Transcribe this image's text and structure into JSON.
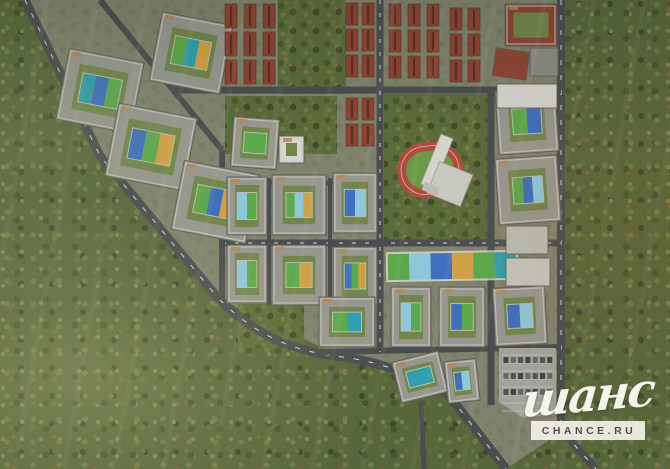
{
  "watermark": {
    "script": "шанс",
    "domain": "CHANCE.RU"
  },
  "palette": {
    "forest": "#57663b",
    "ground": "#81836f",
    "road": "#4a4d4f",
    "road_dash": "#d8d8cf",
    "building_wall": "#97978f",
    "building_edge": "#5f5f5a",
    "roof_trim": "#c9c9c1",
    "roof_accent": "#b2895a",
    "courtyard": "#72854c",
    "brick": "#8d4434",
    "brick_dark": "#5f2d22",
    "white_building": "#d6d5ce",
    "track_red": "#b24b3d",
    "field_green": "#699b47",
    "park_green": "#5c6b3a",
    "parking_gray": "#a2a39c",
    "playground_teal": "#2e9fae",
    "playground_blue": "#3f6fbe",
    "playground_green": "#5ca94c",
    "playground_lightblue": "#8ec7dc",
    "playground_orange": "#d2a044"
  },
  "map": {
    "width": 670,
    "height": 469,
    "features": [
      {
        "t": "ground",
        "n": "development-site-ground",
        "pts": [
          [
            25,
            0
          ],
          [
            561,
            0
          ],
          [
            561,
            432
          ],
          [
            506,
            469
          ],
          [
            446,
            392
          ],
          [
            340,
            356
          ],
          [
            218,
            298
          ],
          [
            100,
            156
          ]
        ]
      },
      {
        "t": "park",
        "n": "park-townhouse-gap",
        "x": 278,
        "y": 0,
        "w": 68,
        "h": 94
      },
      {
        "t": "park",
        "n": "park-central",
        "x": 225,
        "y": 96,
        "w": 112,
        "h": 58
      },
      {
        "t": "park",
        "n": "school-park",
        "x": 384,
        "y": 94,
        "w": 106,
        "h": 152
      },
      {
        "t": "park",
        "n": "park-south",
        "x": 238,
        "y": 304,
        "w": 66,
        "h": 44
      },
      {
        "t": "road",
        "n": "boundary-road-west",
        "d": "M25,0 L100,156 L218,298 C262,342 302,352 342,357 C384,362 416,377 448,394 L506,469",
        "w": 9
      },
      {
        "t": "road",
        "n": "boundary-road-west-markings",
        "d": "M25,0 L100,156 L218,298 C262,342 302,352 342,357 C384,362 416,377 448,394 L506,469",
        "w": 1,
        "c": "dash",
        "dash": "5 10"
      },
      {
        "t": "road",
        "n": "boundary-road-east",
        "d": "M561,0 L561,430 L596,469",
        "w": 8
      },
      {
        "t": "road",
        "n": "boundary-road-east-markings",
        "d": "M561,0 L561,430 L596,469",
        "w": 1,
        "c": "dash",
        "dash": "5 10"
      },
      {
        "t": "road",
        "n": "street-north",
        "d": "M173,90 L561,90",
        "w": 7
      },
      {
        "t": "road",
        "n": "street-central",
        "d": "M222,243 L561,243",
        "w": 7
      },
      {
        "t": "road",
        "n": "street-central-markings",
        "d": "M222,243 L561,243",
        "w": 1,
        "c": "dash",
        "dash": "4 9"
      },
      {
        "t": "road",
        "n": "street-south",
        "d": "M322,352 L561,347",
        "w": 6
      },
      {
        "t": "road",
        "n": "street-south-exit",
        "d": "M421,402 L424,469",
        "w": 5
      },
      {
        "t": "road",
        "n": "street-inner-diagonal",
        "d": "M100,0 L222,150",
        "w": 6
      },
      {
        "t": "road",
        "n": "street-west-vertical",
        "d": "M222,150 L222,300",
        "w": 6
      },
      {
        "t": "road",
        "n": "street-grid-north",
        "d": "M222,183 L380,183",
        "w": 5
      },
      {
        "t": "road",
        "n": "street-grid-vertical-1",
        "d": "M269,178 L269,305",
        "w": 4
      },
      {
        "t": "road",
        "n": "street-grid-vertical-2",
        "d": "M330,178 L330,305",
        "w": 4
      },
      {
        "t": "road",
        "n": "street-mid-vertical",
        "d": "M380,0 L380,352",
        "w": 7
      },
      {
        "t": "road",
        "n": "street-mid-vertical-markings",
        "d": "M380,0 L380,352",
        "w": 1,
        "c": "dash",
        "dash": "4 9"
      },
      {
        "t": "road",
        "n": "street-east-vertical",
        "d": "M491,90 L491,405",
        "w": 7
      },
      {
        "t": "stadium",
        "n": "stadium-running-track",
        "x": 397,
        "y": 142,
        "w": 66,
        "h": 56,
        "rot": -6
      },
      {
        "t": "school",
        "n": "school-building",
        "x": 441,
        "y": 134,
        "rot": 22
      },
      {
        "t": "strip",
        "n": "playground-strip",
        "x": 388,
        "y": 253,
        "w": 128,
        "h": 26,
        "rot": -1,
        "colors": [
          "#5ca94c",
          "#8ec7dc",
          "#3f6fbe",
          "#d2a044",
          "#5ca94c",
          "#2e9fae"
        ]
      },
      {
        "t": "parking",
        "n": "parking-lot",
        "pts": [
          [
            499,
            348
          ],
          [
            556,
            348
          ],
          [
            556,
            414
          ],
          [
            524,
            418
          ],
          [
            499,
            402
          ]
        ]
      },
      {
        "t": "block",
        "n": "courtyard-block-a1",
        "x": 62,
        "y": 55,
        "w": 76,
        "h": 72,
        "rot": 11,
        "pg": [
          "#2e9fae",
          "#3f6fbe",
          "#5ca94c"
        ]
      },
      {
        "t": "block",
        "n": "courtyard-block-a2",
        "x": 155,
        "y": 18,
        "w": 72,
        "h": 70,
        "rot": 11,
        "pg": [
          "#5ca94c",
          "#2e9fae",
          "#d2a044"
        ]
      },
      {
        "t": "block",
        "n": "courtyard-block-a3",
        "x": 111,
        "y": 110,
        "w": 80,
        "h": 74,
        "rot": 11,
        "pg": [
          "#3f6fbe",
          "#5ca94c",
          "#d2a044"
        ]
      },
      {
        "t": "block",
        "n": "courtyard-block-a4",
        "x": 177,
        "y": 167,
        "w": 76,
        "h": 70,
        "rot": 11,
        "pg": [
          "#5ca94c",
          "#3f6fbe",
          "#d2a044"
        ]
      },
      {
        "t": "block",
        "n": "courtyard-block-a5",
        "x": 232,
        "y": 118,
        "w": 46,
        "h": 50,
        "rot": 4,
        "pg": [
          "#5ca94c"
        ]
      },
      {
        "t": "block",
        "n": "courtyard-block-b1",
        "x": 227,
        "y": 177,
        "w": 40,
        "h": 58,
        "pg": [
          "#8ec7dc",
          "#5ca94c"
        ]
      },
      {
        "t": "block",
        "n": "courtyard-block-b2",
        "x": 272,
        "y": 175,
        "w": 54,
        "h": 60,
        "pg": [
          "#5ca94c",
          "#8ec7dc",
          "#d2a044"
        ]
      },
      {
        "t": "block",
        "n": "courtyard-block-b3",
        "x": 333,
        "y": 173,
        "w": 44,
        "h": 60,
        "pg": [
          "#3f6fbe",
          "#8ec7dc"
        ]
      },
      {
        "t": "block",
        "n": "courtyard-block-b4",
        "x": 227,
        "y": 245,
        "w": 40,
        "h": 58,
        "pg": [
          "#8ec7dc",
          "#5ca94c"
        ]
      },
      {
        "t": "block",
        "n": "courtyard-block-b5",
        "x": 272,
        "y": 245,
        "w": 54,
        "h": 60,
        "pg": [
          "#5ca94c",
          "#d2a044"
        ]
      },
      {
        "t": "block",
        "n": "courtyard-block-b6",
        "x": 333,
        "y": 247,
        "w": 44,
        "h": 58,
        "pg": [
          "#3f6fbe",
          "#5ca94c",
          "#d2a044"
        ]
      },
      {
        "t": "block",
        "n": "courtyard-block-b7",
        "x": 319,
        "y": 297,
        "w": 56,
        "h": 50,
        "pg": [
          "#5ca94c",
          "#2e9fae"
        ]
      },
      {
        "t": "block",
        "n": "courtyard-block-c1",
        "x": 391,
        "y": 287,
        "w": 40,
        "h": 60,
        "pg": [
          "#8ec7dc",
          "#5ca94c"
        ]
      },
      {
        "t": "block",
        "n": "courtyard-block-c2",
        "x": 439,
        "y": 287,
        "w": 46,
        "h": 60,
        "pg": [
          "#3f6fbe",
          "#5ca94c"
        ]
      },
      {
        "t": "block",
        "n": "courtyard-block-c3",
        "x": 494,
        "y": 287,
        "w": 52,
        "h": 58,
        "rot": -3,
        "pg": [
          "#3f6fbe",
          "#8ec7dc"
        ]
      },
      {
        "t": "block",
        "n": "courtyard-block-d1",
        "x": 497,
        "y": 89,
        "w": 60,
        "h": 64,
        "rot": -4,
        "pg": [
          "#5ca94c",
          "#3f6fbe"
        ]
      },
      {
        "t": "block",
        "n": "courtyard-block-d2",
        "x": 497,
        "y": 157,
        "w": 62,
        "h": 66,
        "rot": -4,
        "pg": [
          "#5ca94c",
          "#3f6fbe",
          "#8ec7dc"
        ]
      },
      {
        "t": "block",
        "n": "courtyard-block-e1",
        "x": 396,
        "y": 356,
        "w": 48,
        "h": 42,
        "rot": -14,
        "pg": [
          "#2e9fae"
        ]
      },
      {
        "t": "block",
        "n": "courtyard-block-e2",
        "x": 446,
        "y": 360,
        "w": 32,
        "h": 42,
        "rot": -6,
        "pg": [
          "#3f6fbe",
          "#8ec7dc"
        ]
      },
      {
        "t": "block",
        "n": "brick-perimeter-block",
        "x": 505,
        "y": 4,
        "w": 52,
        "h": 42,
        "wc": "#8d4434"
      },
      {
        "t": "block",
        "n": "b-shaped-building",
        "x": 279,
        "y": 136,
        "w": 25,
        "h": 27,
        "wc": "#d6d5ce"
      },
      {
        "t": "building",
        "n": "white-slab-building",
        "x": 497,
        "y": 84,
        "w": 60,
        "h": 24,
        "c": "#d6d5ce"
      },
      {
        "t": "building",
        "n": "brick-building-angled",
        "x": 494,
        "y": 50,
        "w": 34,
        "h": 28,
        "rot": 8,
        "c": "#8d4434"
      },
      {
        "t": "building",
        "n": "gray-building-northeast",
        "x": 530,
        "y": 48,
        "w": 28,
        "h": 28,
        "c": "#8b8b85"
      },
      {
        "t": "building",
        "n": "slab-building-east-1",
        "x": 506,
        "y": 226,
        "w": 42,
        "h": 28,
        "c": "#bcbcb4"
      },
      {
        "t": "building",
        "n": "slab-building-east-2",
        "x": 506,
        "y": 258,
        "w": 44,
        "h": 28,
        "c": "#c6c6be"
      },
      {
        "t": "townhouses",
        "n": "townhouse-rows-1",
        "cols": [
          225,
          244,
          263
        ],
        "rows": [
          4,
          32,
          60
        ],
        "bw": 12,
        "bh": 24
      },
      {
        "t": "townhouses",
        "n": "townhouse-rows-2",
        "cols": [
          346,
          362
        ],
        "rows": [
          3,
          29,
          55,
          98,
          124
        ],
        "bw": 12,
        "bh": 22
      },
      {
        "t": "townhouses",
        "n": "townhouse-rows-3",
        "cols": [
          389,
          408,
          427
        ],
        "rows": [
          4,
          30,
          56
        ],
        "bw": 12,
        "bh": 22
      },
      {
        "t": "townhouses",
        "n": "townhouse-rows-4",
        "cols": [
          450,
          468
        ],
        "rows": [
          8,
          34,
          60
        ],
        "bw": 12,
        "bh": 22
      }
    ]
  }
}
